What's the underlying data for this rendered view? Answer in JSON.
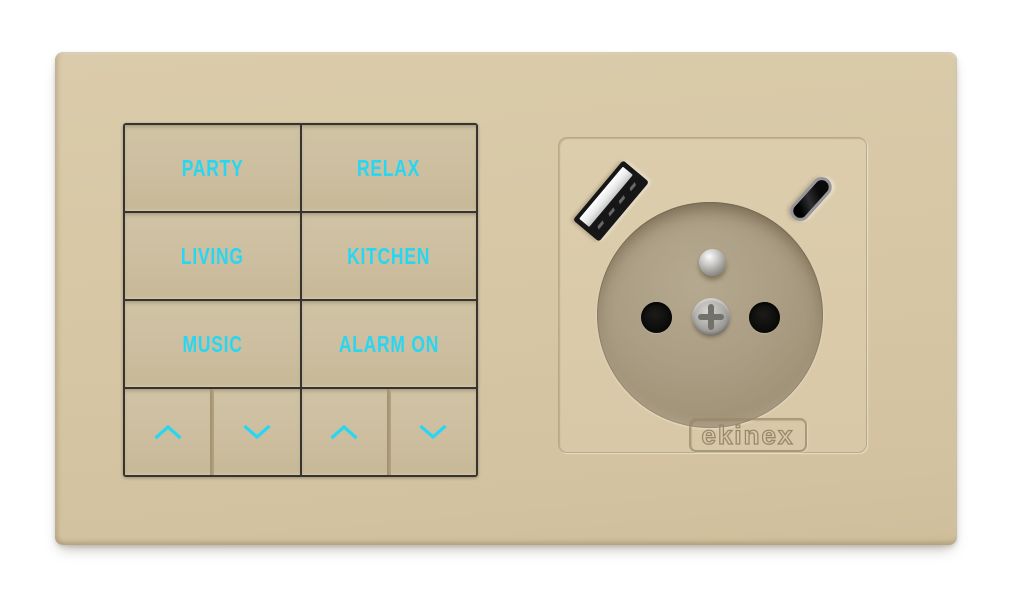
{
  "device": {
    "brand": "ekinex"
  },
  "keypad": {
    "scene_buttons": [
      {
        "id": "party",
        "label": "PARTY"
      },
      {
        "id": "relax",
        "label": "RELAX"
      },
      {
        "id": "living",
        "label": "LIVING"
      },
      {
        "id": "kitchen",
        "label": "KITCHEN"
      },
      {
        "id": "music",
        "label": "MUSIC"
      },
      {
        "id": "alarm-on",
        "label": "ALARM ON"
      }
    ],
    "rockers": [
      {
        "icon": "chevron-up-icon"
      },
      {
        "icon": "chevron-down-icon"
      },
      {
        "icon": "chevron-up-icon"
      },
      {
        "icon": "chevron-down-icon"
      }
    ],
    "label_color": "#29d6f2"
  },
  "socket": {
    "brand_label": "ekinex",
    "ports": [
      "usb-a-port",
      "usb-c-port",
      "type-e-socket"
    ]
  },
  "colors": {
    "background": "#ffffff",
    "plate": "#d6c6a4",
    "button": "#ccbe9f",
    "frame": "#35342f",
    "accent_cyan": "#29d6f2",
    "socket_recess": "#a89b80"
  }
}
